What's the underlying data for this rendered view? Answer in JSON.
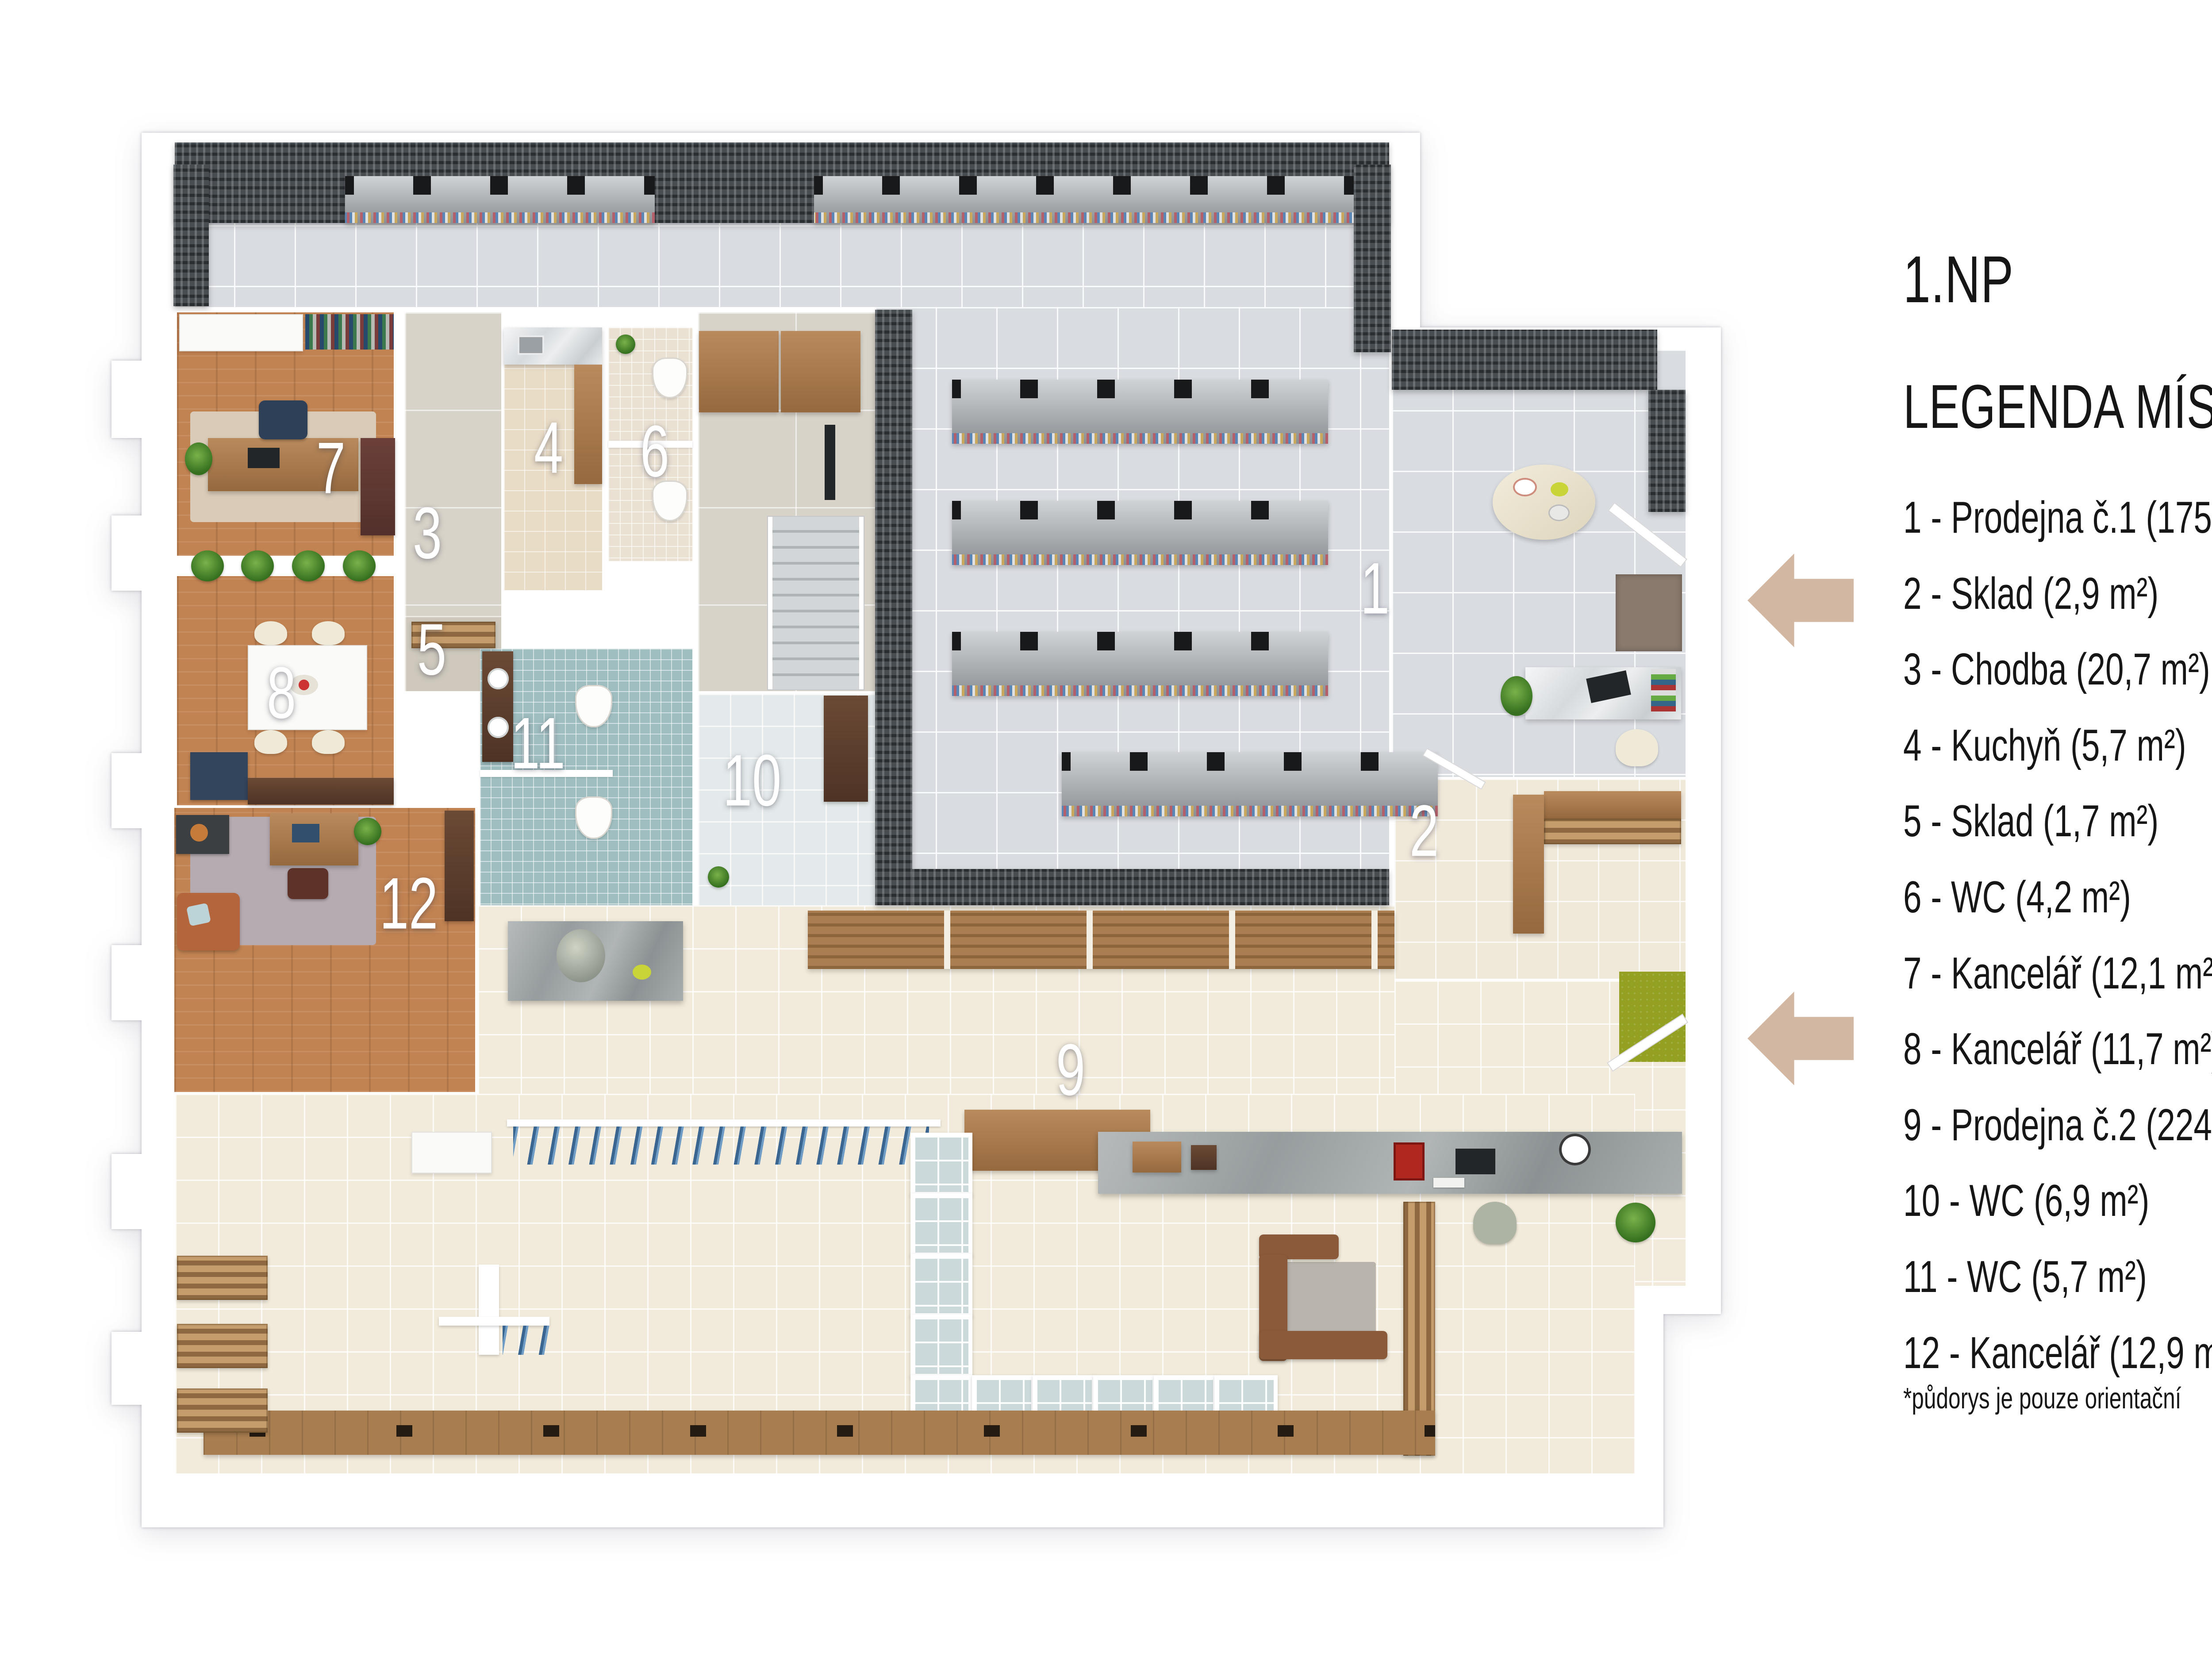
{
  "title": "1.NP",
  "legend": {
    "heading": "LEGENDA MÍSTNOSTÍ:",
    "items": [
      "1 - Prodejna č.1 (175 m²)",
      "2 - Sklad (2,9 m²)",
      "3 - Chodba (20,7 m²)",
      "4 - Kuchyň (5,7 m²)",
      "5 - Sklad (1,7 m²)",
      "6 - WC (4,2 m²)",
      "7 - Kancelář (12,1 m²)",
      "8 - Kancelář (11,7 m²)",
      "9 - Prodejna č.2 (224,2 m²)",
      "10 - WC (6,9 m²)",
      "11 - WC (5,7 m²)",
      "12 - Kancelář (12,9 m²)"
    ],
    "note": "*půdorys je pouze orientační"
  },
  "plan": {
    "room_numbers": [
      "1",
      "2",
      "3",
      "4",
      "5",
      "6",
      "7",
      "8",
      "9",
      "10",
      "11",
      "12"
    ]
  },
  "colors": {
    "arrow": "#d2b8a3",
    "shop1_floor": "#d9dce1",
    "shop2_floor": "#f2ebdb",
    "wood_floor": "#c28352",
    "shelving_dark": "#484d52",
    "wc_mosaic": "#9fbec0",
    "legend_text": "#161616"
  }
}
